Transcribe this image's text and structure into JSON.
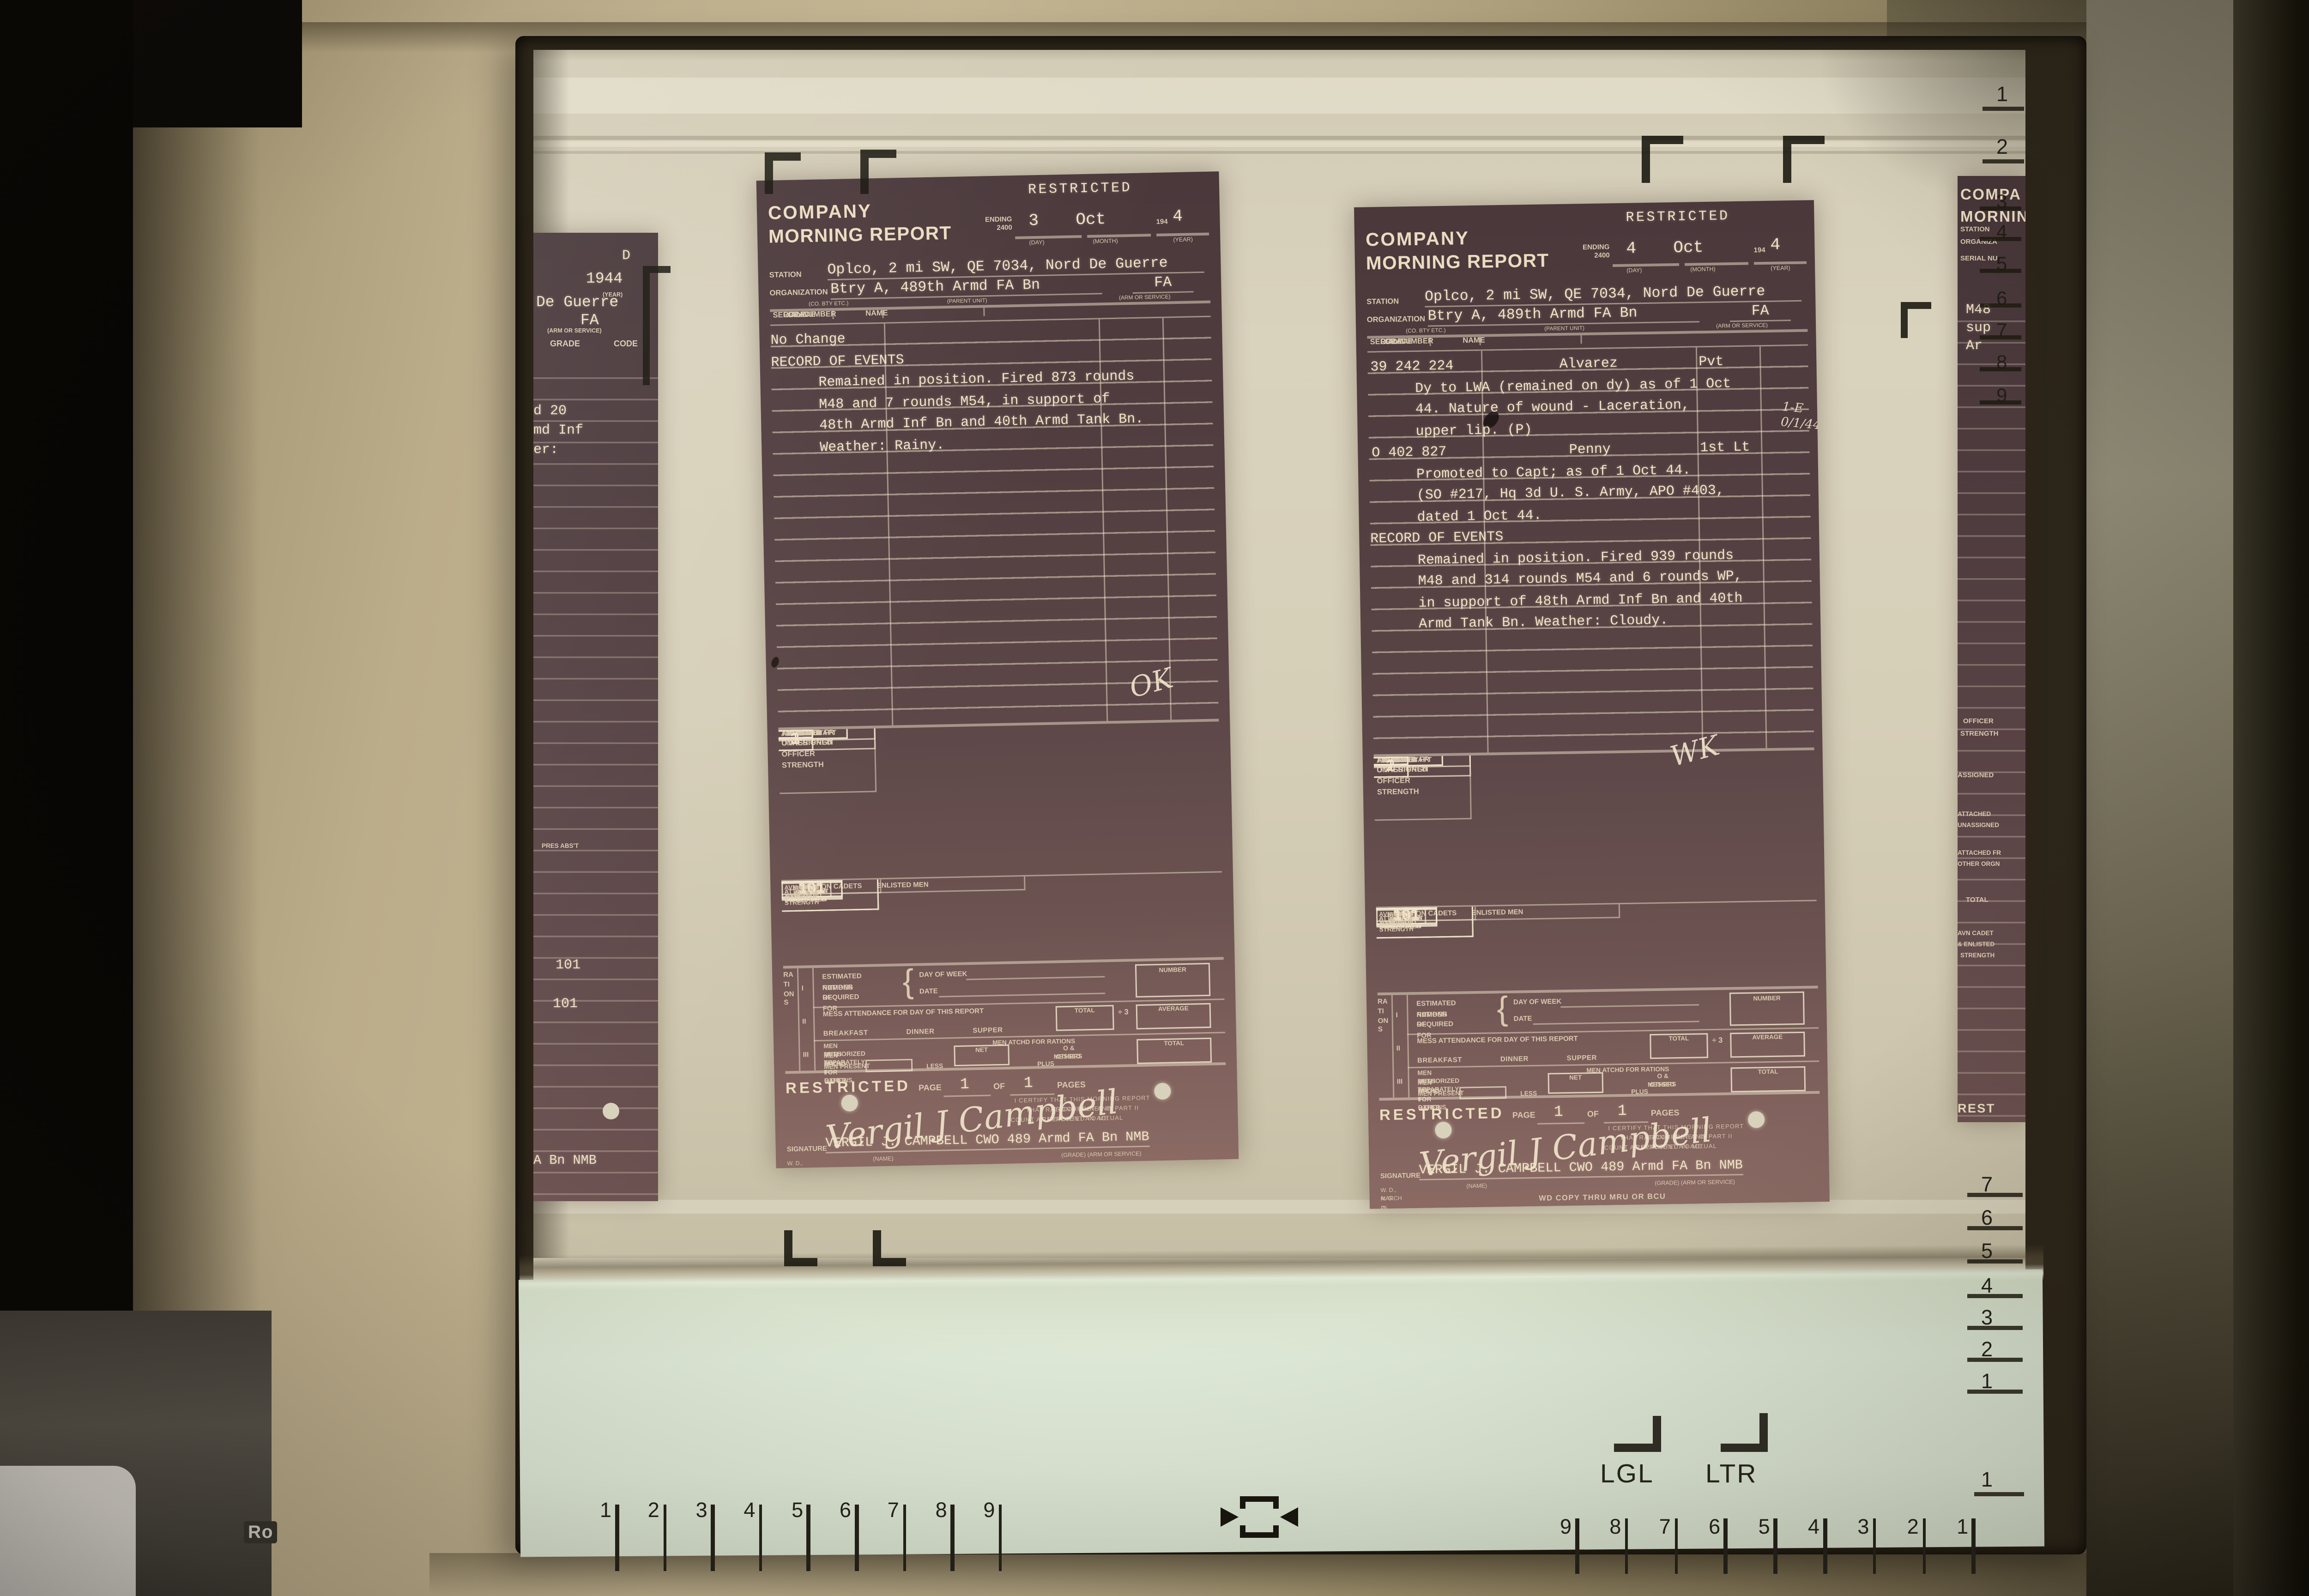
{
  "device": {
    "ro_label": "Ro"
  },
  "screen": {
    "format_labels": {
      "lgl": "LGL",
      "ltr": "LTR"
    },
    "rulers": {
      "bottom_left": [
        "1",
        "2",
        "3",
        "4",
        "5",
        "6",
        "7",
        "8",
        "9"
      ],
      "bottom_right": [
        "9",
        "8",
        "7",
        "6",
        "5",
        "4",
        "3",
        "2",
        "1"
      ],
      "right_top": [
        "1",
        "2"
      ],
      "right_mid": [
        "3",
        "4",
        "5",
        "6",
        "7",
        "8",
        "9"
      ],
      "right_bottom": [
        "7",
        "6",
        "5",
        "4",
        "3",
        "2",
        "1"
      ],
      "corner_one": "1"
    }
  },
  "form": {
    "title1": "COMPANY",
    "title2": "MORNING REPORT",
    "restricted": "RESTRICTED",
    "ending": "ENDING\n2400",
    "day_sub": "(DAY)",
    "month_sub": "(MONTH)",
    "year_sub": "(YEAR)",
    "year_prefix": "194",
    "station_label": "STATION",
    "organization_label": "ORGANIZATION",
    "co_sub": "(CO. BTY ETC.)",
    "parent_sub": "(PARENT UNIT)",
    "arm_value": "FA",
    "arm_sub": "(ARM OR SERVICE)",
    "roster_headers": [
      "SERIAL NUMBER",
      "NAME",
      "GRADE",
      "CODE"
    ],
    "officer_label": "OFFICER\nSTRENGTH",
    "officer_groups": [
      "FLD O & CAPT",
      "1ST LT",
      "2D LT",
      "WO",
      "FLT O"
    ],
    "pres": "PRES",
    "abst": "ABS'T",
    "row_labels": [
      "ASSIGNED",
      "ATTACHED\nUNASSIGNED",
      "ATTACHED FR\nOTHER ORGN",
      "TOTAL"
    ],
    "avn_label": "AVN CADET\n& ENLISTED\nSTRENGTH",
    "avn_group": "AVIATION CADETS",
    "em_group": "ENLISTED MEN",
    "avn_cols": [
      "PRESENT",
      "ABSENT"
    ],
    "em_cols": [
      "PRESENT\nFOR DUTY",
      "PRESENT\nNOT FOR DY",
      "ABSENT",
      "PRESENT\nAND ABSENT"
    ],
    "rations_word": "RATIONS",
    "roman": [
      "I",
      "II",
      "III"
    ],
    "est1": "ESTIMATED NUMBER OF",
    "est2": "RATIONS REQUIRED FOR",
    "brace": "{",
    "day_of_week": "DAY OF WEEK",
    "date_label": "DATE",
    "number_label": "NUMBER",
    "mess_attendance": "MESS ATTENDANCE FOR DAY OF THIS REPORT",
    "total_label": "TOTAL",
    "divide3": "÷ 3",
    "average_label": "AVERAGE",
    "meals": "BREAKFAST DINNER SUPPER",
    "auth1": "MEN AUTHORIZED TO",
    "auth2": "MESS SEPARATELY",
    "atchd_rations": "MEN ATCHD FOR RATIONS",
    "atchd1": "MEN ATCHD TO OTHER",
    "atchd2": "ORGN FOR RATIONS",
    "net_label": "NET",
    "others1": "O & OTHERS",
    "others2": "MESSED",
    "men_present": "MEN PRESENT",
    "less_label": "LESS",
    "plus_label": "PLUS",
    "page_label": "PAGE",
    "page_no": "1",
    "of_label": "OF",
    "page_total": "1",
    "pages_label": "PAGES",
    "cert1": "I CERTIFY THAT THIS MORNING REPORT IS CORRECT AND",
    "cert2": "THAT RATION FIGURES IN PART II REPRESENT AN ACTUAL",
    "cert3": "COUNT AS REPORTED TO ME.",
    "signature_label": "SIGNATURE",
    "name_sub": "(NAME)",
    "grade_arm_sub": "(GRADE)  (ARM OR SERVICE)",
    "form_no": "W. D., A. G. O. FORM NO. 1",
    "form_date": "MARCH 25, 1943",
    "wd_copy": "WD COPY THRU MRU OR BCU"
  },
  "documents": {
    "doc1": {
      "day": "3",
      "month": "Oct",
      "year_digit": "4",
      "station_value": "Oplco, 2 mi SW, QE 7034, Nord De Guerre",
      "org_value": "Btry A, 489th Armd FA Bn",
      "initials": "OK",
      "signature_script": "Vergil J Campbell",
      "signature_typed": "VERGIL J. CAMPBELL CWO 489 Armd FA Bn NMB",
      "roster": [
        {
          "text": "No Change",
          "align": "center"
        },
        {
          "text": "RECORD OF EVENTS",
          "align": "center"
        },
        {
          "text": "Remained in position.  Fired 873 rounds"
        },
        {
          "text": "M48 and 7 rounds M54, in support of"
        },
        {
          "text": "48th Armd Inf Bn and 40th Armd Tank Bn."
        },
        {
          "text": "Weather:  Rainy."
        }
      ],
      "officer_rows": [
        [
          "",
          "",
          "3",
          "",
          "1",
          "",
          "",
          "",
          "",
          ""
        ],
        [
          "",
          "",
          "",
          "",
          "",
          "",
          "",
          "",
          "",
          ""
        ],
        [
          "",
          "",
          "",
          "",
          "",
          "",
          "",
          "",
          "",
          ""
        ],
        [
          "",
          "",
          "3",
          "",
          "1",
          "",
          "",
          "",
          "",
          ""
        ]
      ],
      "enlisted_rows": [
        [
          "",
          "",
          "101",
          "",
          "",
          "101"
        ],
        [
          "",
          "",
          "",
          "",
          "",
          ""
        ],
        [
          "",
          "",
          "",
          "",
          "",
          ""
        ],
        [
          "",
          "",
          "101",
          "",
          "",
          "101"
        ]
      ]
    },
    "doc2": {
      "day": "4",
      "month": "Oct",
      "year_digit": "4",
      "station_value": "Oplco, 2 mi SW, QE 7034, Nord De Guerre",
      "org_value": "Btry A, 489th Armd FA Bn",
      "initials": "WK",
      "annotation": "1-E\n0/1/44",
      "signature_script": "Vergil J Campbell",
      "signature_typed": "VERGIL J. CAMPBELL CWO 489 Armd FA Bn NMB",
      "roster": [
        {
          "serial": "39 242 224",
          "name": "Alvarez",
          "grade": "Pvt"
        },
        {
          "text": "Dy to LWA (remained on dy) as of 1 Oct"
        },
        {
          "text": "44.  Nature of wound - Laceration,"
        },
        {
          "text": "upper lip.  (P)"
        },
        {
          "serial": "O 402 827",
          "name": "Penny",
          "grade": "1st Lt"
        },
        {
          "text": "Promoted to Capt; as of 1 Oct 44."
        },
        {
          "text": "(SO #217, Hq 3d U. S. Army, APO #403,"
        },
        {
          "text": "dated 1 Oct 44."
        },
        {
          "text": "RECORD OF EVENTS",
          "align": "center"
        },
        {
          "text": "Remained in position.  Fired 939 rounds"
        },
        {
          "text": "M48 and 314 rounds M54 and 6 rounds WP,"
        },
        {
          "text": "in support of 48th Armd Inf Bn and 40th"
        },
        {
          "text": "Armd Tank Bn.  Weather:  Cloudy."
        }
      ],
      "officer_rows": [
        [
          "1",
          "",
          "2",
          "",
          "1",
          "",
          "",
          "",
          "",
          ""
        ],
        [
          "",
          "",
          "",
          "",
          "",
          "",
          "",
          "",
          "",
          ""
        ],
        [
          "",
          "",
          "",
          "",
          "",
          "",
          "",
          "",
          "",
          ""
        ],
        [
          "1",
          "",
          "2",
          "",
          "1",
          "",
          "",
          "",
          "",
          ""
        ]
      ],
      "enlisted_rows": [
        [
          "",
          "",
          "101",
          "",
          "",
          "101"
        ],
        [
          "",
          "",
          "",
          "",
          "",
          ""
        ],
        [
          "",
          "",
          "",
          "",
          "",
          ""
        ],
        [
          "",
          "",
          "101",
          "",
          "",
          "101"
        ]
      ]
    }
  },
  "partials": {
    "left": {
      "fragments": [
        "D",
        "1944",
        "(YEAR)",
        "De Guerre",
        "FA",
        "(ARM OR SERVICE)",
        "GRADE",
        "CODE",
        "d 20",
        "md Inf",
        "er:",
        "PRES  ABS'T",
        "101",
        "101",
        "A Bn NMB"
      ]
    },
    "right": {
      "fragments": [
        "COMPA",
        "MORNIN",
        "STATION",
        "ORGANIZA",
        "SERIAL NU",
        "M48",
        "sup",
        "Ar",
        "OFFICER",
        "STRENGTH",
        "ASSIGNED",
        "ATTACHED",
        "UNASSIGNED",
        "ATTACHED FR",
        "OTHER ORGN",
        "TOTAL",
        "AVN CADET",
        "& ENLISTED",
        "STRENGTH",
        "REST",
        "SIGNA"
      ]
    }
  },
  "colors": {
    "film": "#d8d1bc",
    "screen_lower": "#dfe9d7",
    "document_page": "#553f42",
    "document_text": "#f0e3c7",
    "bezel": "#b2a584",
    "overlay_marks": "#17150d"
  }
}
